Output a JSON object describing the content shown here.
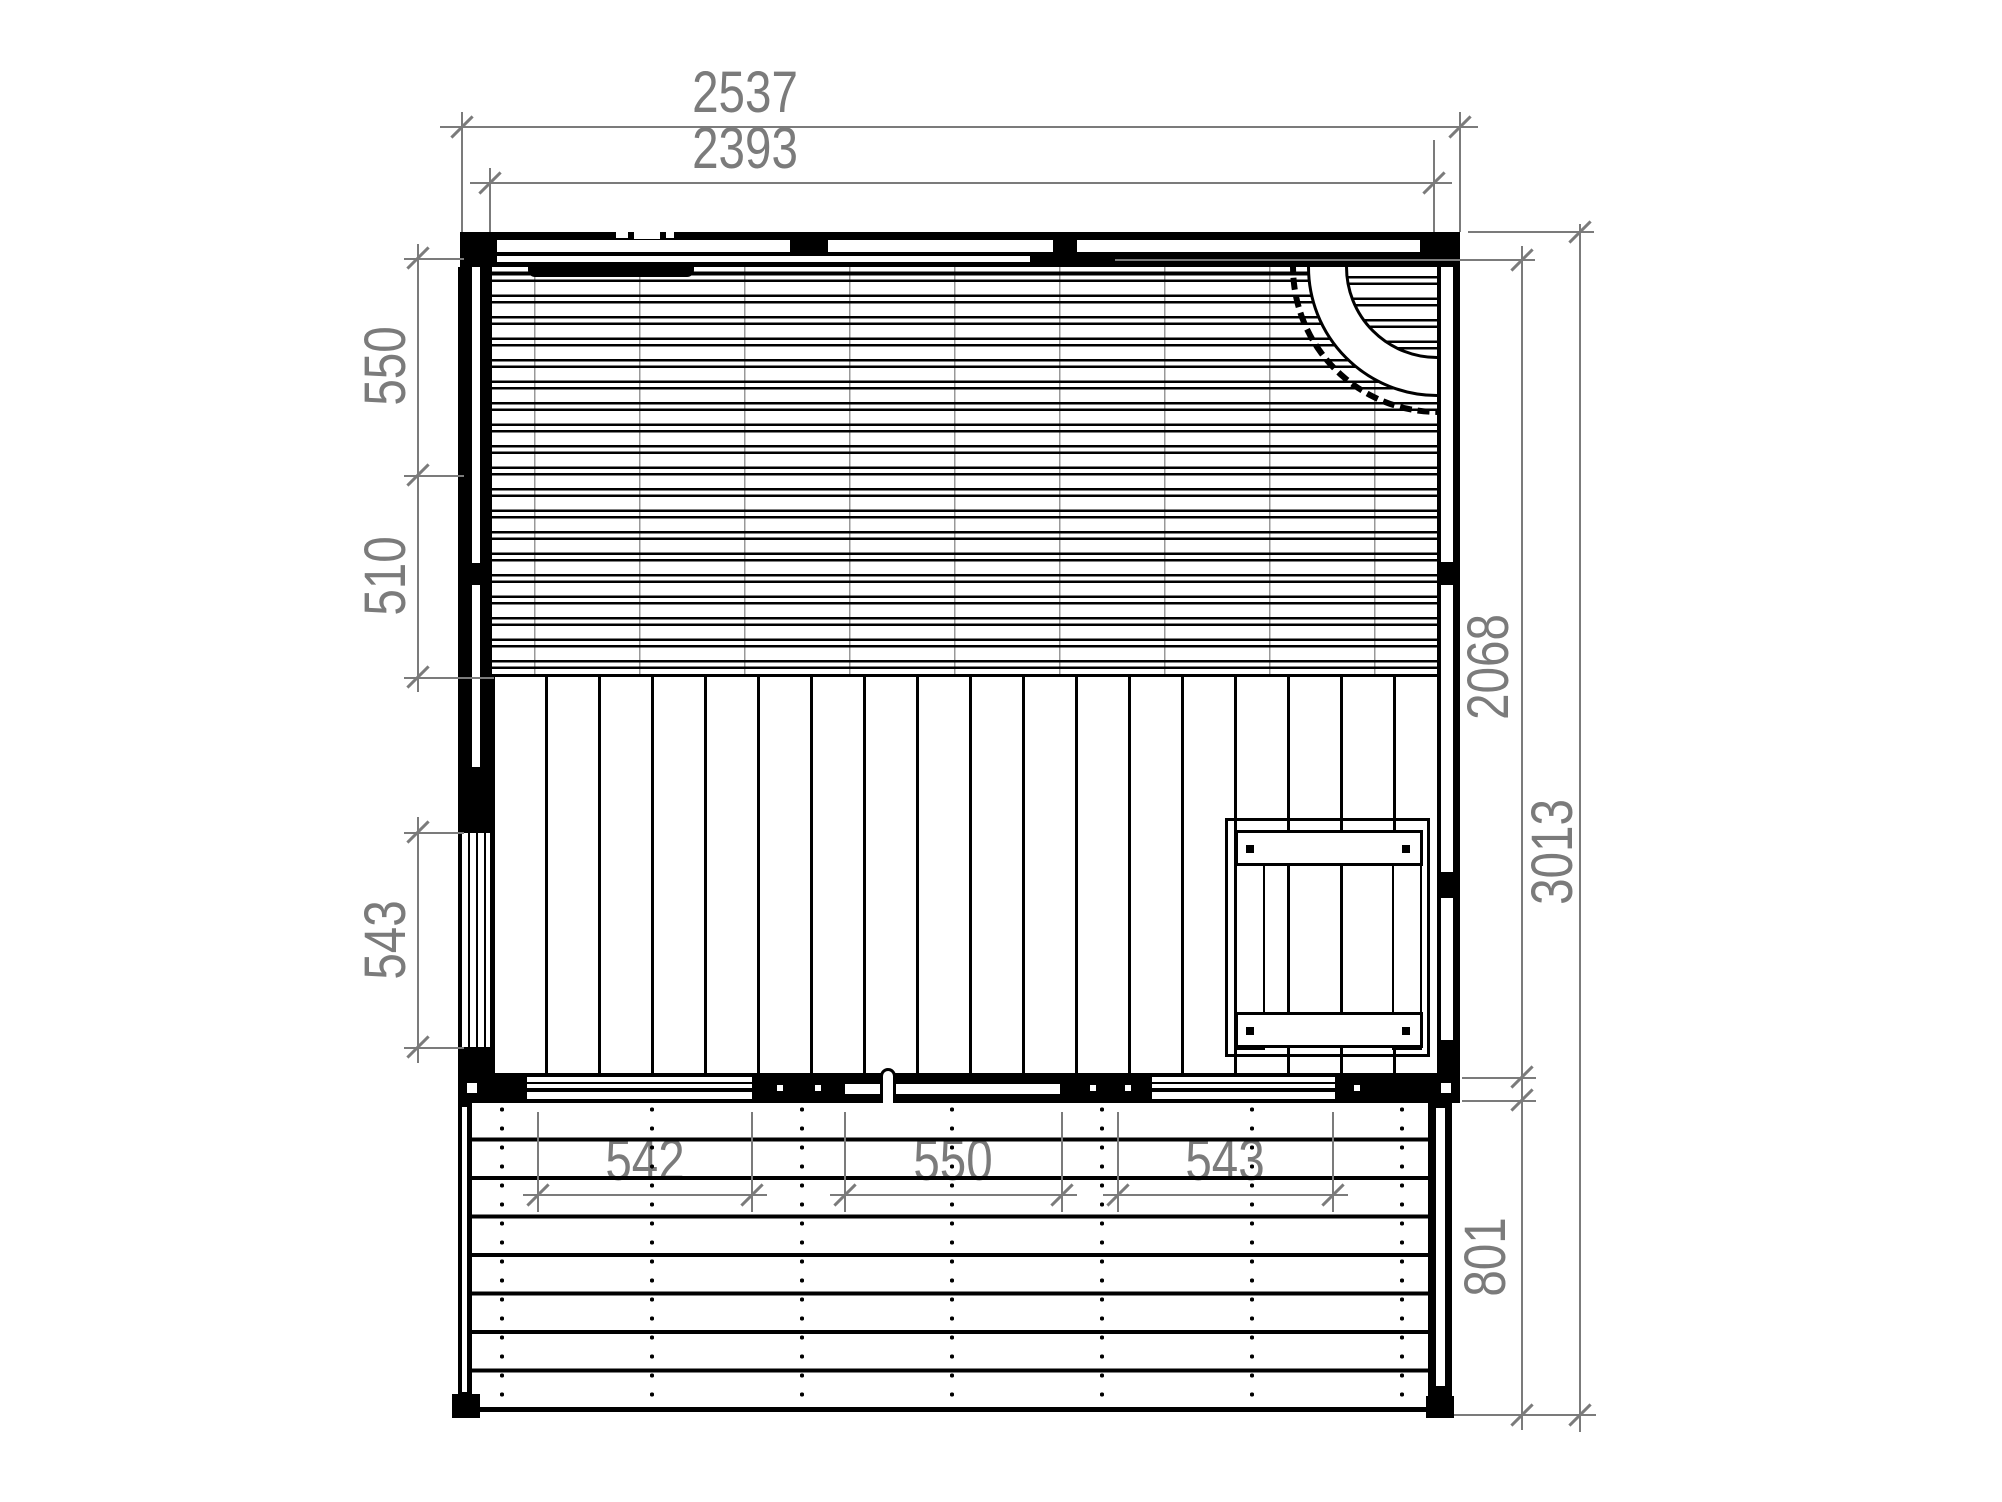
{
  "dimensions": {
    "top_outer": "2537",
    "top_inner": "2393",
    "left_upper": "550",
    "left_mid": "510",
    "left_window": "543",
    "right_room_depth": "2068",
    "right_total_depth": "3013",
    "terrace_depth": "801",
    "terrace_left_opening": "542",
    "terrace_door": "550",
    "terrace_right_opening": "543"
  },
  "colors": {
    "ink": "#000000",
    "dimension_gray": "#7b7b7b",
    "background": "#ffffff"
  },
  "symbols": {
    "door_swing": "quarter-arc-with-dashed-sweep",
    "door_handle": "capsule-pull",
    "deck_fasteners": "dotted-screw-rows",
    "wall_windows": "glazing-line-openings"
  }
}
